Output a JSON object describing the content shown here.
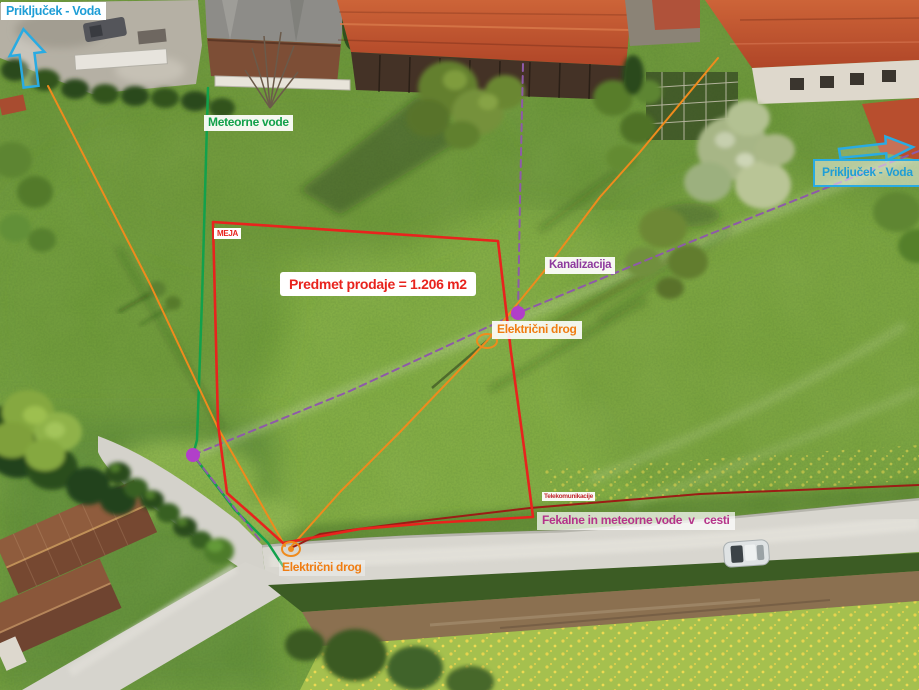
{
  "labels": {
    "prikljucek_voda_left": {
      "text": "Priključek - Voda",
      "color": "#1f9ed6"
    },
    "meteorne_vode": {
      "text": "Meteorne vode",
      "color": "#12a14b"
    },
    "meja": {
      "text": "MEJA",
      "color": "#e8231d"
    },
    "predmet_prodaje": {
      "text": "Predmet prodaje = 1.206 m2",
      "color": "#e8231d"
    },
    "kanalizacija": {
      "text": "Kanalizacija",
      "color": "#8e3a9e"
    },
    "elektricni_drog_sredina": {
      "text": "Električni drog",
      "color": "#f07d12"
    },
    "prikljucek_voda_right": {
      "text": "Priključek - Voda",
      "color": "#1f9ed6"
    },
    "telekomunikacije": {
      "text": "Telekomunikacije",
      "color": "#c1272d"
    },
    "fekalne_vode": {
      "text": "Fekalne in meteorne vode  v   cesti",
      "color": "#b5338a"
    },
    "elektricni_drog_spodaj": {
      "text": "Električni drog",
      "color": "#f07d12"
    }
  },
  "lines": {
    "boundary_color": "#e8231d",
    "storm_water_color": "#12a14b",
    "sewer_color": "#8e5aa8",
    "power_color": "#ef8b1d",
    "telecom_color": "#9b1c15",
    "pole_marker_color": "#b13fc9",
    "water_arrow_color": "#29abe2"
  }
}
